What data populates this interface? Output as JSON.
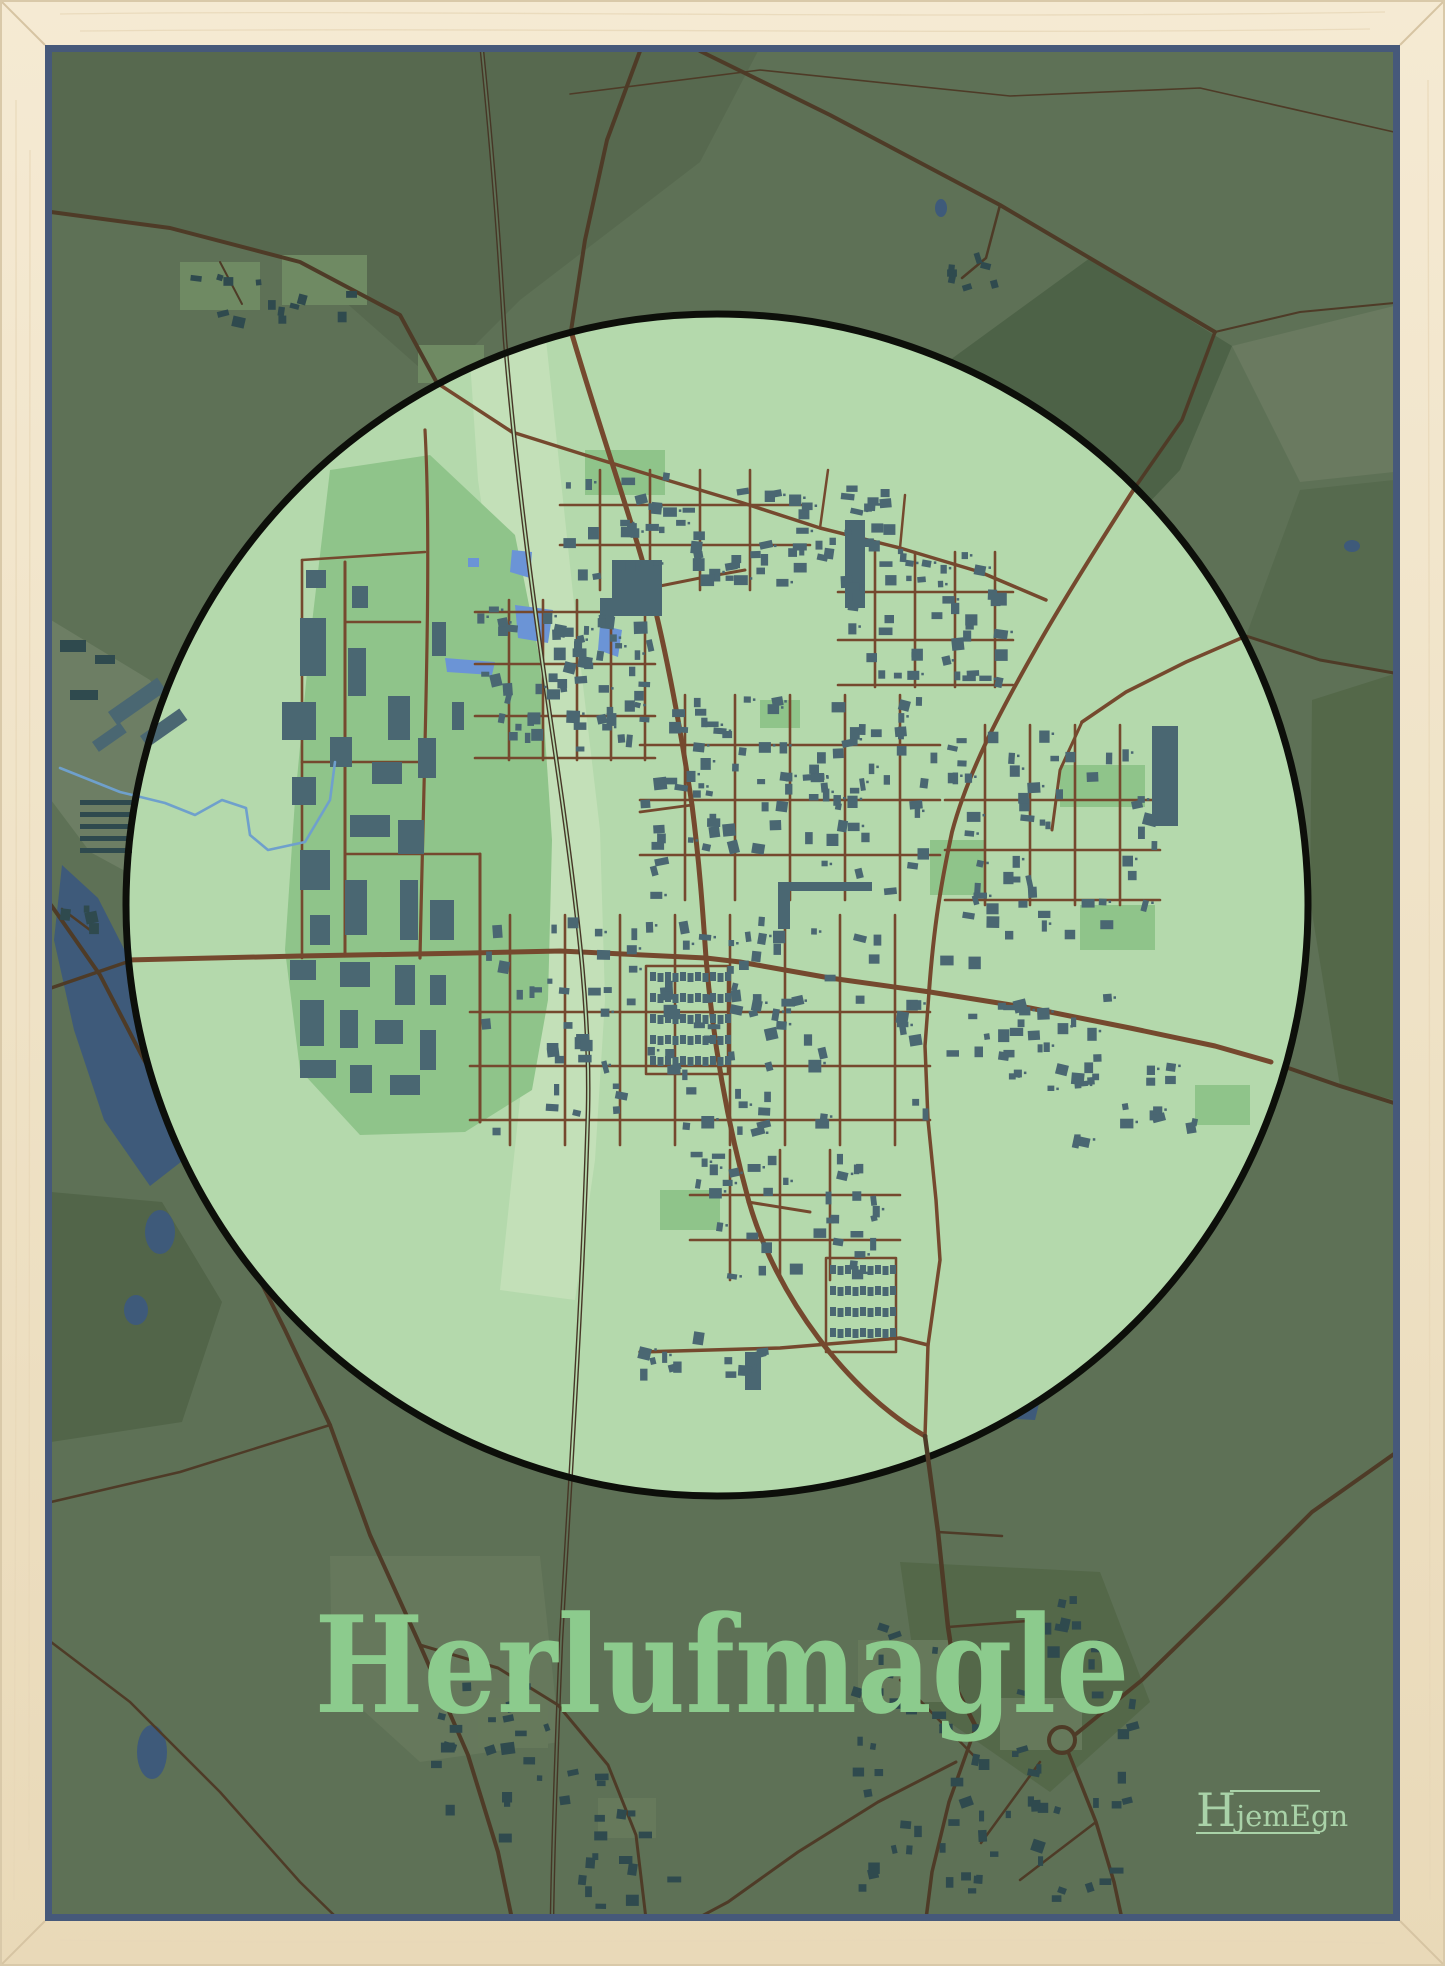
{
  "poster": {
    "title": "Herlufmagle",
    "brand": {
      "initial": "H",
      "rest": "jemEgn"
    }
  },
  "colors": {
    "frame_wood_light": "#f5ead3",
    "frame_wood": "#eee0c2",
    "frame_wood_dark": "#e7d6b4",
    "frame_inner_shadow": "#46597a",
    "map_background": "#5e7156",
    "circle_fill": "#b4d9ac",
    "circle_outline": "#0d0f0a",
    "road_town": "#75492e",
    "road_rural": "#4e3b27",
    "railway": "#463626",
    "building_town": "#4a6772",
    "building_rural": "#2f4a4e",
    "water_lake": "#3e5a7a",
    "water_pond": "#6b94d6",
    "stream": "#6fa0cc",
    "green_field": "#8fc48a",
    "green_pale": "#c3e0b8",
    "title_text": "#8ccb8d",
    "logo_text": "#a9d2a8"
  }
}
